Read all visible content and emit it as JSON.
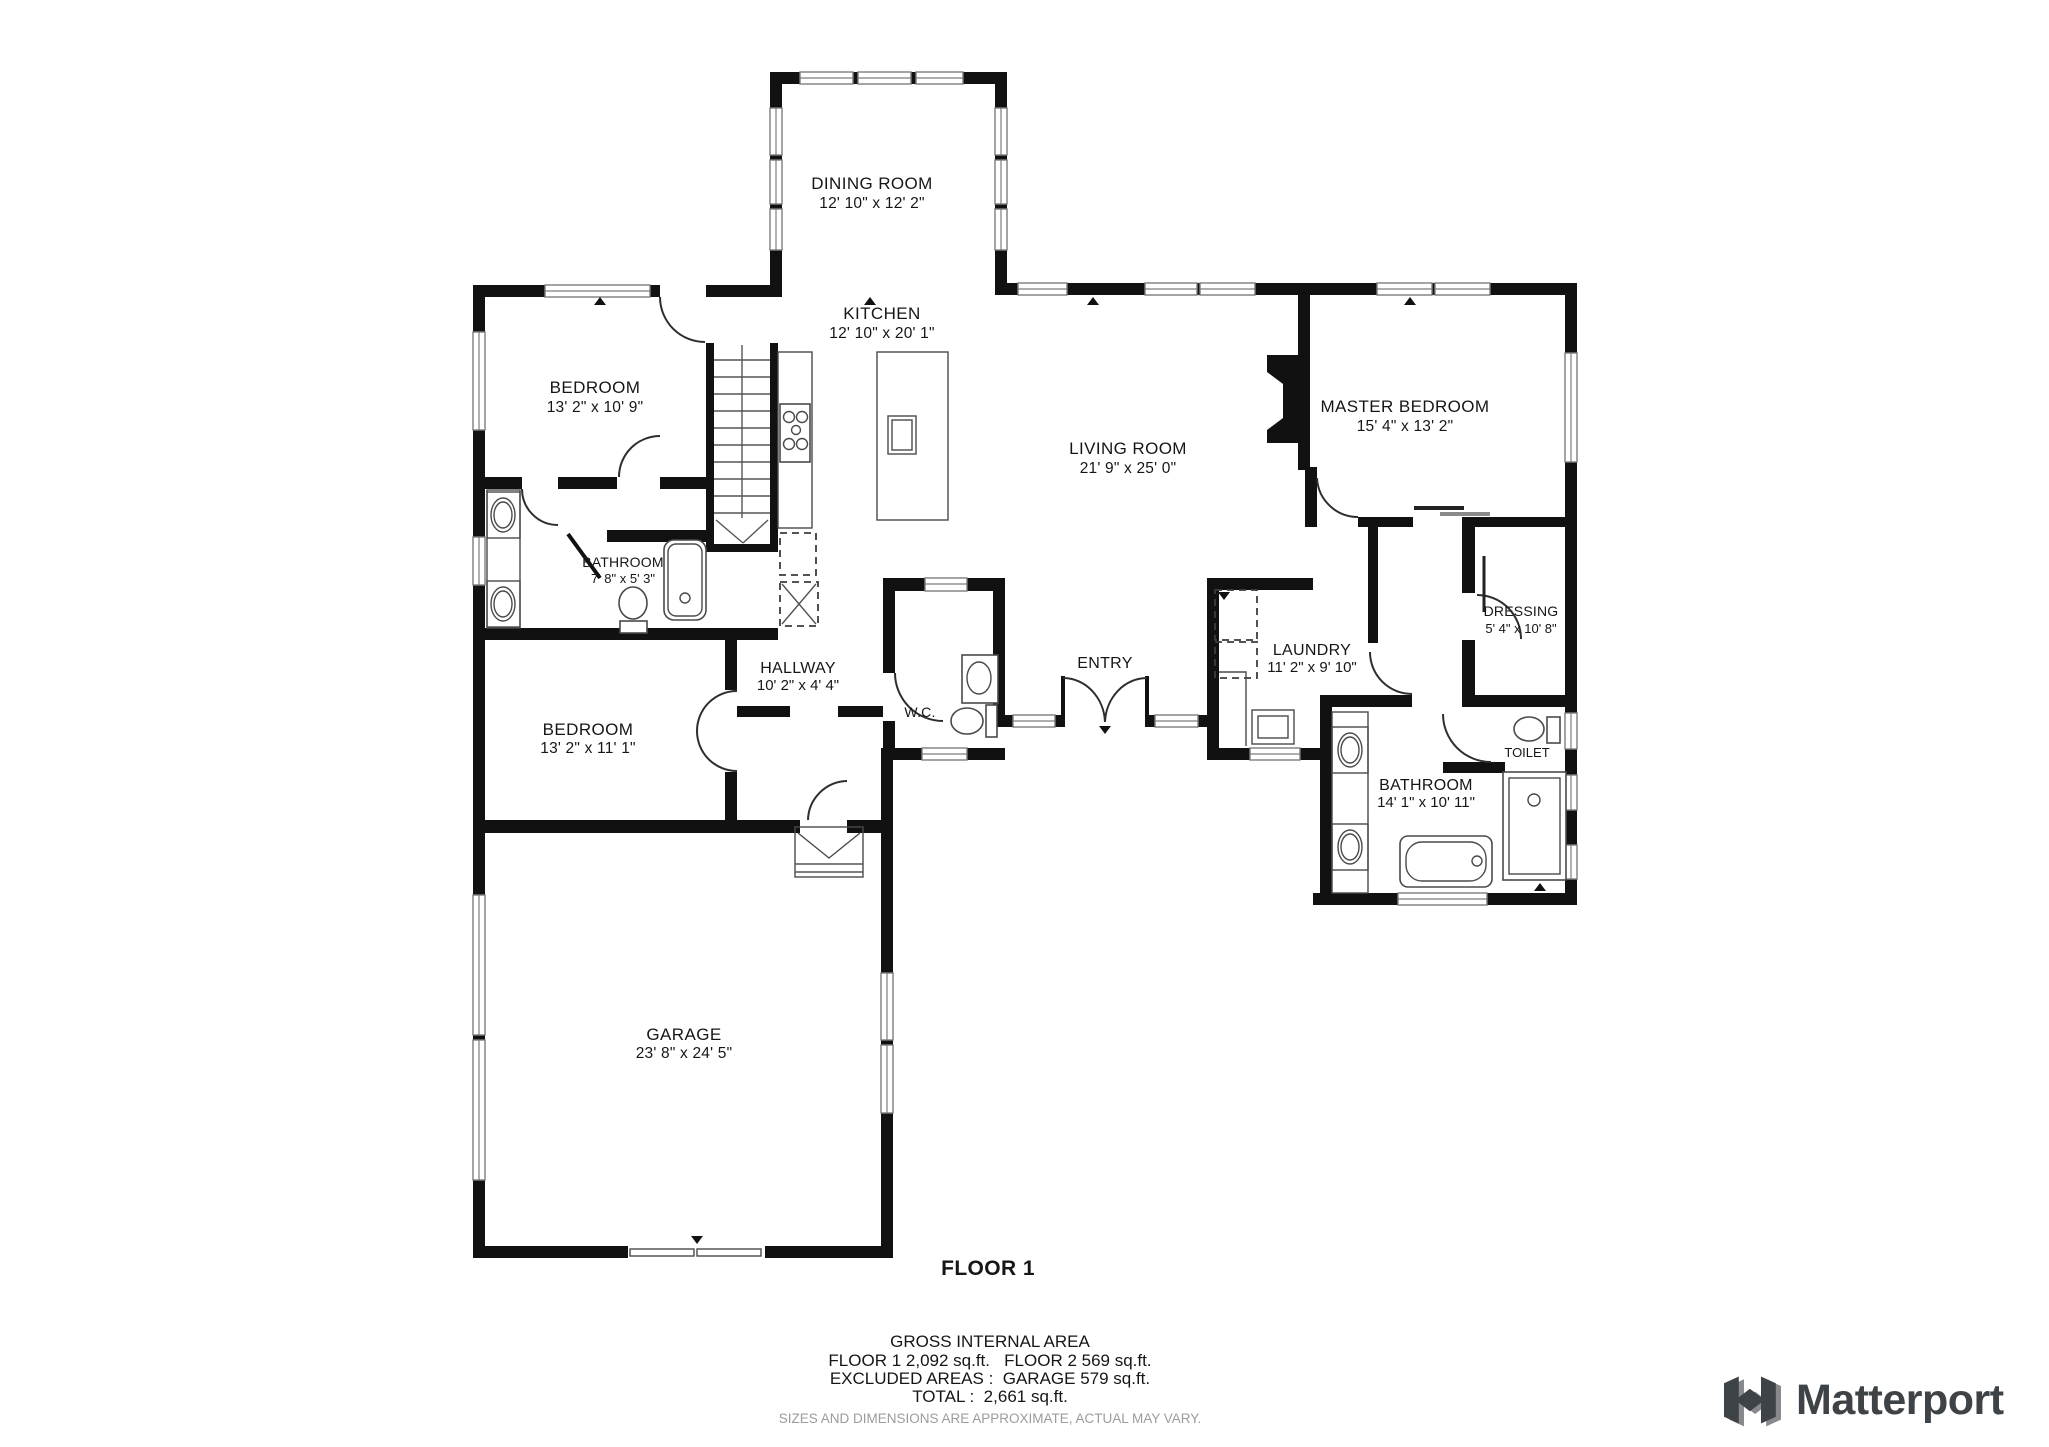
{
  "plan": {
    "floor_title": "FLOOR 1",
    "rooms": {
      "dining": {
        "name": "DINING ROOM",
        "dims": "12' 10\" x 12' 2\""
      },
      "kitchen": {
        "name": "KITCHEN",
        "dims": "12' 10\" x 20' 1\""
      },
      "living": {
        "name": "LIVING ROOM",
        "dims": "21' 9\" x 25' 0\""
      },
      "master": {
        "name": "MASTER BEDROOM",
        "dims": "15' 4\" x 13' 2\""
      },
      "bedroom1": {
        "name": "BEDROOM",
        "dims": "13' 2\" x 10' 9\""
      },
      "bathroom1": {
        "name": "BATHROOM",
        "dims": "7' 8\" x 5' 3\""
      },
      "bedroom2": {
        "name": "BEDROOM",
        "dims": "13' 2\" x 11' 1\""
      },
      "hallway": {
        "name": "HALLWAY",
        "dims": "10' 2\" x 4' 4\""
      },
      "wc": {
        "name": "W.C."
      },
      "entry": {
        "name": "ENTRY"
      },
      "laundry": {
        "name": "LAUNDRY",
        "dims": "11' 2\" x 9' 10\""
      },
      "dressing": {
        "name": "DRESSING",
        "dims": "5' 4\" x 10' 8\""
      },
      "toilet": {
        "name": "TOILET"
      },
      "bathroom2": {
        "name": "BATHROOM",
        "dims": "14' 1\" x 10' 11\""
      },
      "garage": {
        "name": "GARAGE",
        "dims": "23' 8\" x 24' 5\""
      }
    },
    "summary": {
      "title": "GROSS INTERNAL AREA",
      "line1": "FLOOR 1 2,092 sq.ft.   FLOOR 2 569 sq.ft.",
      "line2": "EXCLUDED AREAS :  GARAGE 579 sq.ft.",
      "line3": "TOTAL :  2,661 sq.ft.",
      "note": "SIZES AND DIMENSIONS ARE APPROXIMATE, ACTUAL MAY VARY."
    },
    "colors": {
      "wall": "#111111",
      "text": "#161616",
      "note": "#9c9c9c",
      "brand": "#3e4347"
    }
  },
  "brand": {
    "name": "Matterport"
  }
}
